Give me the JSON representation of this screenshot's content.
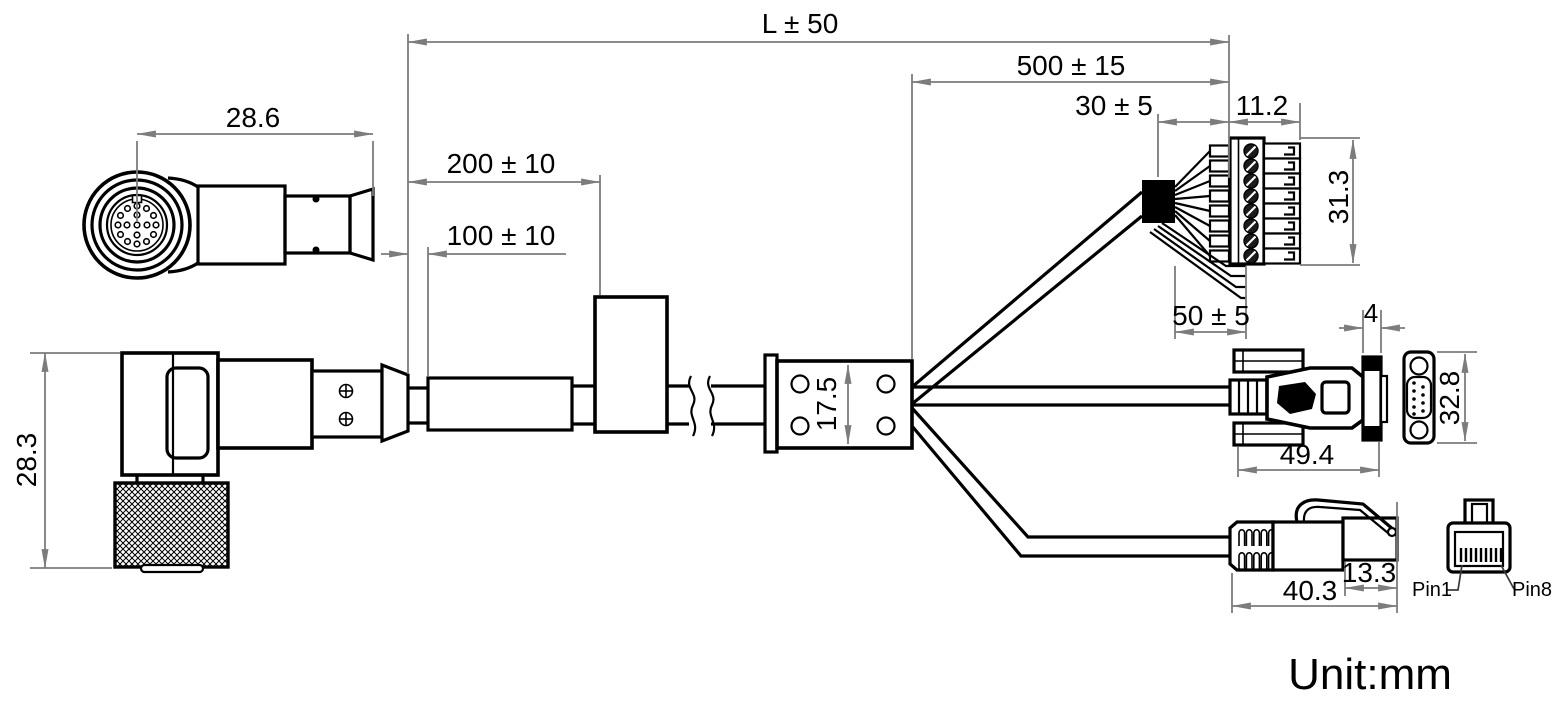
{
  "drawing": {
    "unit_label": "Unit:mm",
    "dimensions": {
      "overall_length": "L ± 50",
      "breakout_length": "500 ± 15",
      "breakout_strip": "30 ± 5",
      "terminal_width": "11.2",
      "terminal_height": "31.3",
      "wire_strip": "50 ± 5",
      "circular_connector_length": "28.6",
      "ferrite_position": "200 ± 10",
      "label_position": "100 ± 10",
      "connector_height": "28.3",
      "junction_height": "17.5",
      "dsub_flange": "4",
      "dsub_height": "32.8",
      "dsub_length": "49.4",
      "rj45_plug": "13.3",
      "rj45_length": "40.3"
    },
    "pin_labels": {
      "first": "Pin1",
      "last": "Pin8"
    },
    "colors": {
      "outline": "#000000",
      "dimension": "#7c7c7c",
      "text": "#000000",
      "background": "#ffffff"
    }
  }
}
